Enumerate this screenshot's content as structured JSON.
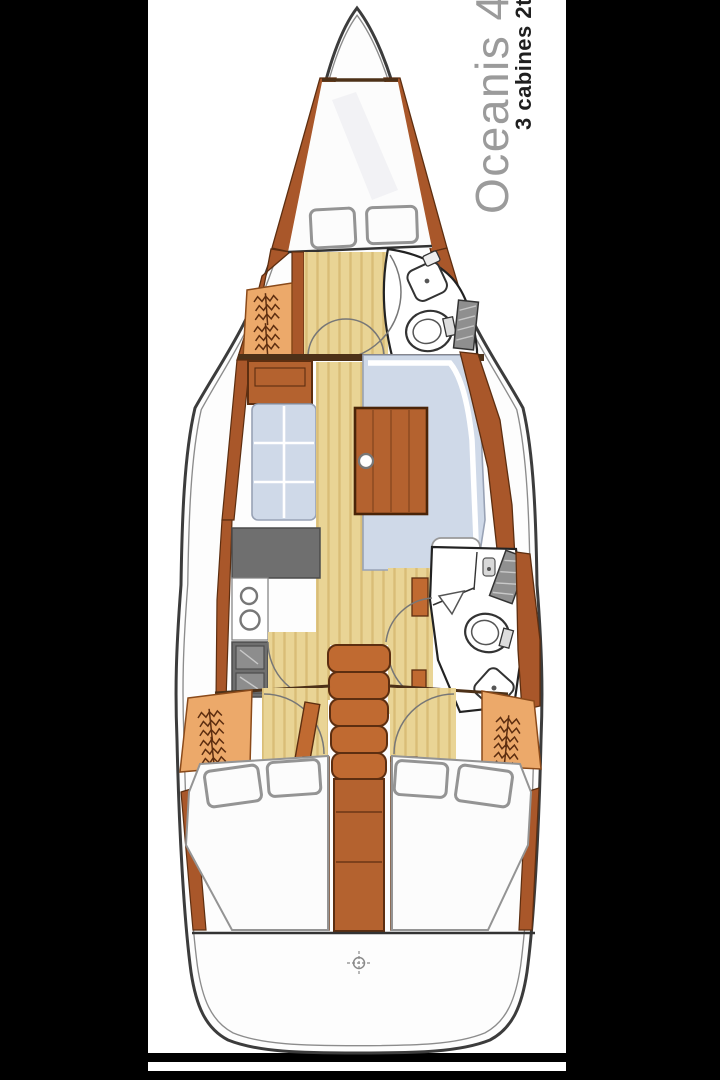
{
  "branding": {
    "model": "Oceanis 41",
    "layout_label": "3 cabines 2t"
  },
  "palette": {
    "model_color": "#9b9b9b",
    "label_color": "#1f1f1f",
    "page_black": "#000000",
    "sheet_white": "#ffffff",
    "hull_stroke": "#3c3c3c",
    "hull_inner": "#8c8c8c",
    "wood_dark": "#a9572a",
    "wood_mid": "#b4622f",
    "wood_step": "#c06a31",
    "wood_light": "#eca96a",
    "wood_outline": "#5d2e10",
    "bulkhead": "#4d3118",
    "floor_tan": "#e9d495",
    "floor_stripe": "#d9bd77",
    "settee_blue": "#cfd9e8",
    "settee_line": "#98a2b5",
    "mattress_white": "#fcfcfc",
    "mattress_line": "#949494",
    "appliance_gray": "#6f6f6f",
    "appliance_light": "#8d8d8d",
    "fixture_stroke": "#333333",
    "arc_gray": "#777777"
  },
  "icons": {
    "compass": "compass-icon",
    "hanging_clothes": "hanging-clothes-icon",
    "toilet": "toilet-icon",
    "sink": "sink-icon",
    "shower_grate": "shower-grate-icon",
    "galley_sink": "galley-sink-icon",
    "stove": "stove-icon",
    "mast_base": "mast-base-icon",
    "steps": "companionway-steps"
  }
}
